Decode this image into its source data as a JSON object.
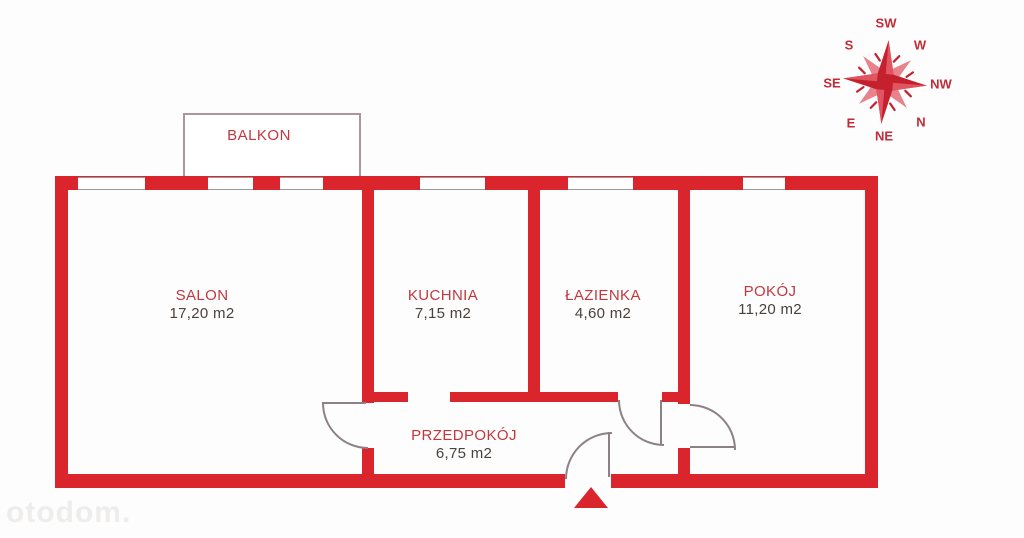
{
  "plan": {
    "balcony_label": "BALKON",
    "rooms": [
      {
        "name": "SALON",
        "area": "17,20 m2"
      },
      {
        "name": "KUCHNIA",
        "area": "7,15 m2"
      },
      {
        "name": "ŁAZIENKA",
        "area": "4,60 m2"
      },
      {
        "name": "POKÓJ",
        "area": "11,20 m2"
      },
      {
        "name": "PRZEDPOKÓJ",
        "area": "6,75 m2"
      }
    ]
  },
  "compass": {
    "labels": {
      "top": "SW",
      "top_right": "W",
      "right": "NW",
      "bottom_right": "N",
      "bottom": "NE",
      "bottom_left": "E",
      "left": "SE",
      "top_left": "S"
    }
  },
  "watermark": "otodom.",
  "colors": {
    "wall_red": "#d9252b",
    "compass_dark": "#c5202e",
    "compass_light": "#e8838c",
    "room_name_red": "#c1383f",
    "area_text": "#4a413d"
  }
}
